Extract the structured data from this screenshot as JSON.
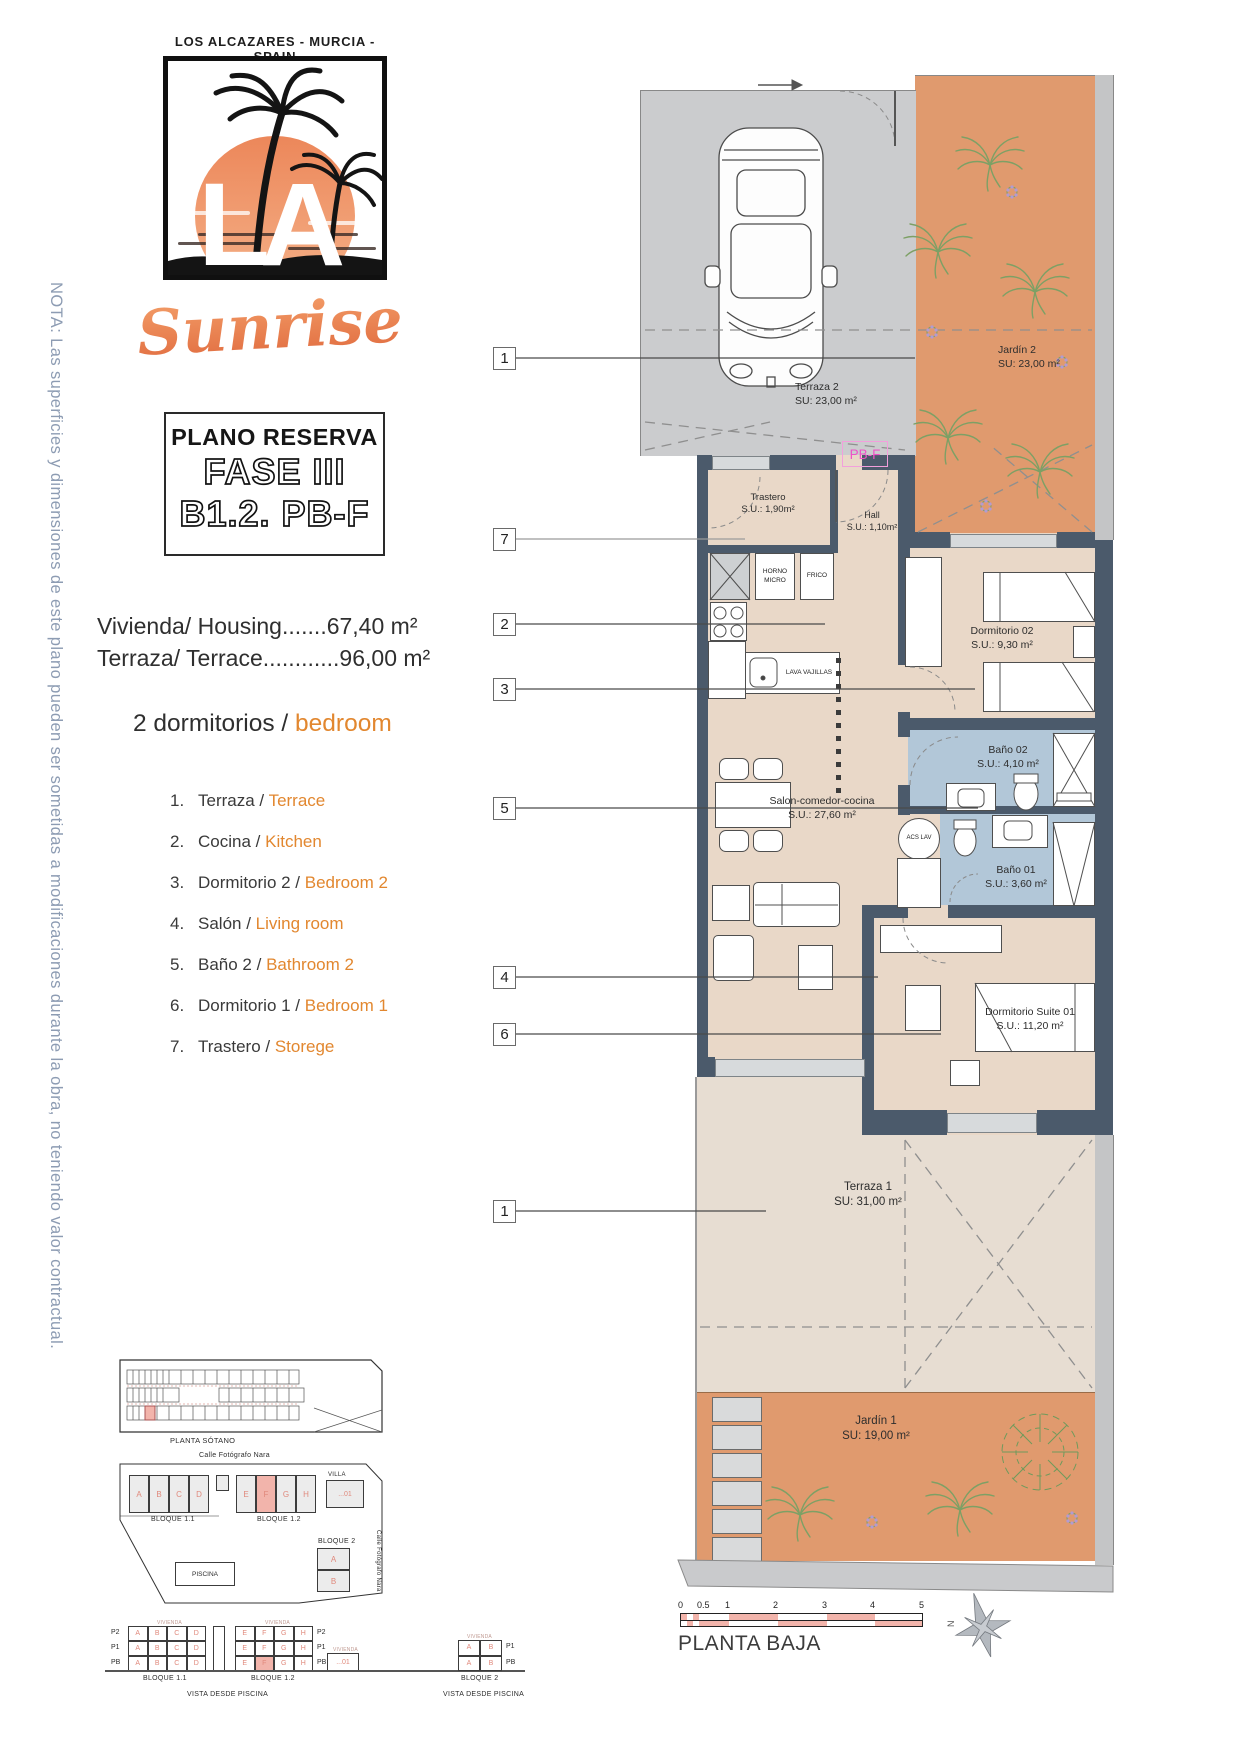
{
  "note_vertical": "NOTA: Las superficies y dimensiones de este plano pueden ser sometidas a modificaciones durante la obra, no teniendo valor contractual.",
  "brand": {
    "location": "LOS ALCAZARES - MURCIA - SPAIN",
    "logo_letters": "LA",
    "logo_script": "Sunrise"
  },
  "title_box": {
    "line1": "PLANO RESERVA",
    "line2": "FASE III",
    "line3": "B1.2. PB-F"
  },
  "summary": {
    "housing": "Vivienda/ Housing.......67,40 m²",
    "terrace": "Terraza/ Terrace............96,00 m²"
  },
  "bedrooms_heading": {
    "es": "2 dormitorios /",
    "en": "bedroom"
  },
  "legend": [
    {
      "num": "1.",
      "es": "Terraza /",
      "en": "Terrace"
    },
    {
      "num": "2.",
      "es": "Cocina /",
      "en": "Kitchen"
    },
    {
      "num": "3.",
      "es": "Dormitorio 2 /",
      "en": "Bedroom 2"
    },
    {
      "num": "4.",
      "es": "Salón /",
      "en": "Living room"
    },
    {
      "num": "5.",
      "es": "Baño 2 /",
      "en": "Bathroom 2"
    },
    {
      "num": "6.",
      "es": "Dormitorio 1 /",
      "en": "Bedroom 1"
    },
    {
      "num": "7.",
      "es": "Trastero /",
      "en": "Storege"
    }
  ],
  "plan": {
    "unit_tag": "PB-F",
    "rooms": {
      "terraza2": {
        "name": "Terraza 2",
        "area": "SU: 23,00 m²"
      },
      "jardin2": {
        "name": "Jardín 2",
        "area": "SU: 23,00 m²"
      },
      "trastero": {
        "name": "Trastero",
        "area": "S.U.: 1,90m²"
      },
      "hall": {
        "name": "Hall",
        "area": "S.U.: 1,10m²"
      },
      "dormitorio02": {
        "name": "Dormitorio 02",
        "area": "S.U.: 9,30 m²"
      },
      "bano02": {
        "name": "Baño 02",
        "area": "S.U.: 4,10 m²"
      },
      "bano01": {
        "name": "Baño 01",
        "area": "S.U.: 3,60 m²"
      },
      "salon": {
        "name": "Salon-comedor-cocina",
        "area": "S.U.: 27,60 m²"
      },
      "suite": {
        "name": "Dormitorio Suite 01",
        "area": "S.U.: 11,20 m²"
      },
      "terraza1": {
        "name": "Terraza 1",
        "area": "SU: 31,00 m²"
      },
      "jardin1": {
        "name": "Jardín 1",
        "area": "SU: 19,00 m²"
      }
    },
    "appliances": {
      "oven": "HORNO MICRO",
      "fridge": "FRICO",
      "dishwasher": "LAVA VAJILLAS",
      "water_heater": "ACS LAV"
    },
    "callouts": [
      "1",
      "7",
      "2",
      "3",
      "5",
      "4",
      "6",
      "1"
    ]
  },
  "site": {
    "sotano_caption": "PLANTA SÓTANO",
    "street_top": "Calle Fotógrafo Nara",
    "street_right": "Calle Fotógrafo Nara",
    "letters_1": [
      "A",
      "B",
      "C",
      "D"
    ],
    "letters_2": [
      "E",
      "F",
      "G",
      "H"
    ],
    "bloque11": "BLOQUE 1.1",
    "bloque12": "BLOQUE 1.2",
    "bloque2": "BLOQUE 2",
    "bloque2_letters": [
      "A",
      "B"
    ],
    "villa": "VILLA",
    "villa_num": "...01",
    "piscina": "PISCINA"
  },
  "elevations": {
    "rows": [
      "P2",
      "P1",
      "PB"
    ],
    "rows_b2": [
      "P1",
      "PB"
    ],
    "micro_label": "VIVIENDA",
    "caption_left": "VISTA DESDE PISCINA",
    "caption_right": "VISTA DESDE PISCINA",
    "bloque11": "BLOQUE 1.1",
    "bloque12": "BLOQUE 1.2",
    "bloque2": "BLOQUE 2",
    "villa_num": "...01"
  },
  "footer": {
    "scale_ticks": [
      "0",
      "0.5",
      "1",
      "2",
      "3",
      "4",
      "5"
    ],
    "floor_label": "PLANTA BAJA",
    "north_letter": "N"
  },
  "colors": {
    "wall": "#4b5a6b",
    "garden": "#e09a6e",
    "bath": "#b2c7d8",
    "floor": "#e9d8c8",
    "terrace": "#e7ddd2",
    "garage": "#cbccce",
    "highlight": "#f2b4ab",
    "accent_orange": "#e2872f",
    "magenta": "#ef53c8",
    "note_blue": "#8d9cb3"
  }
}
